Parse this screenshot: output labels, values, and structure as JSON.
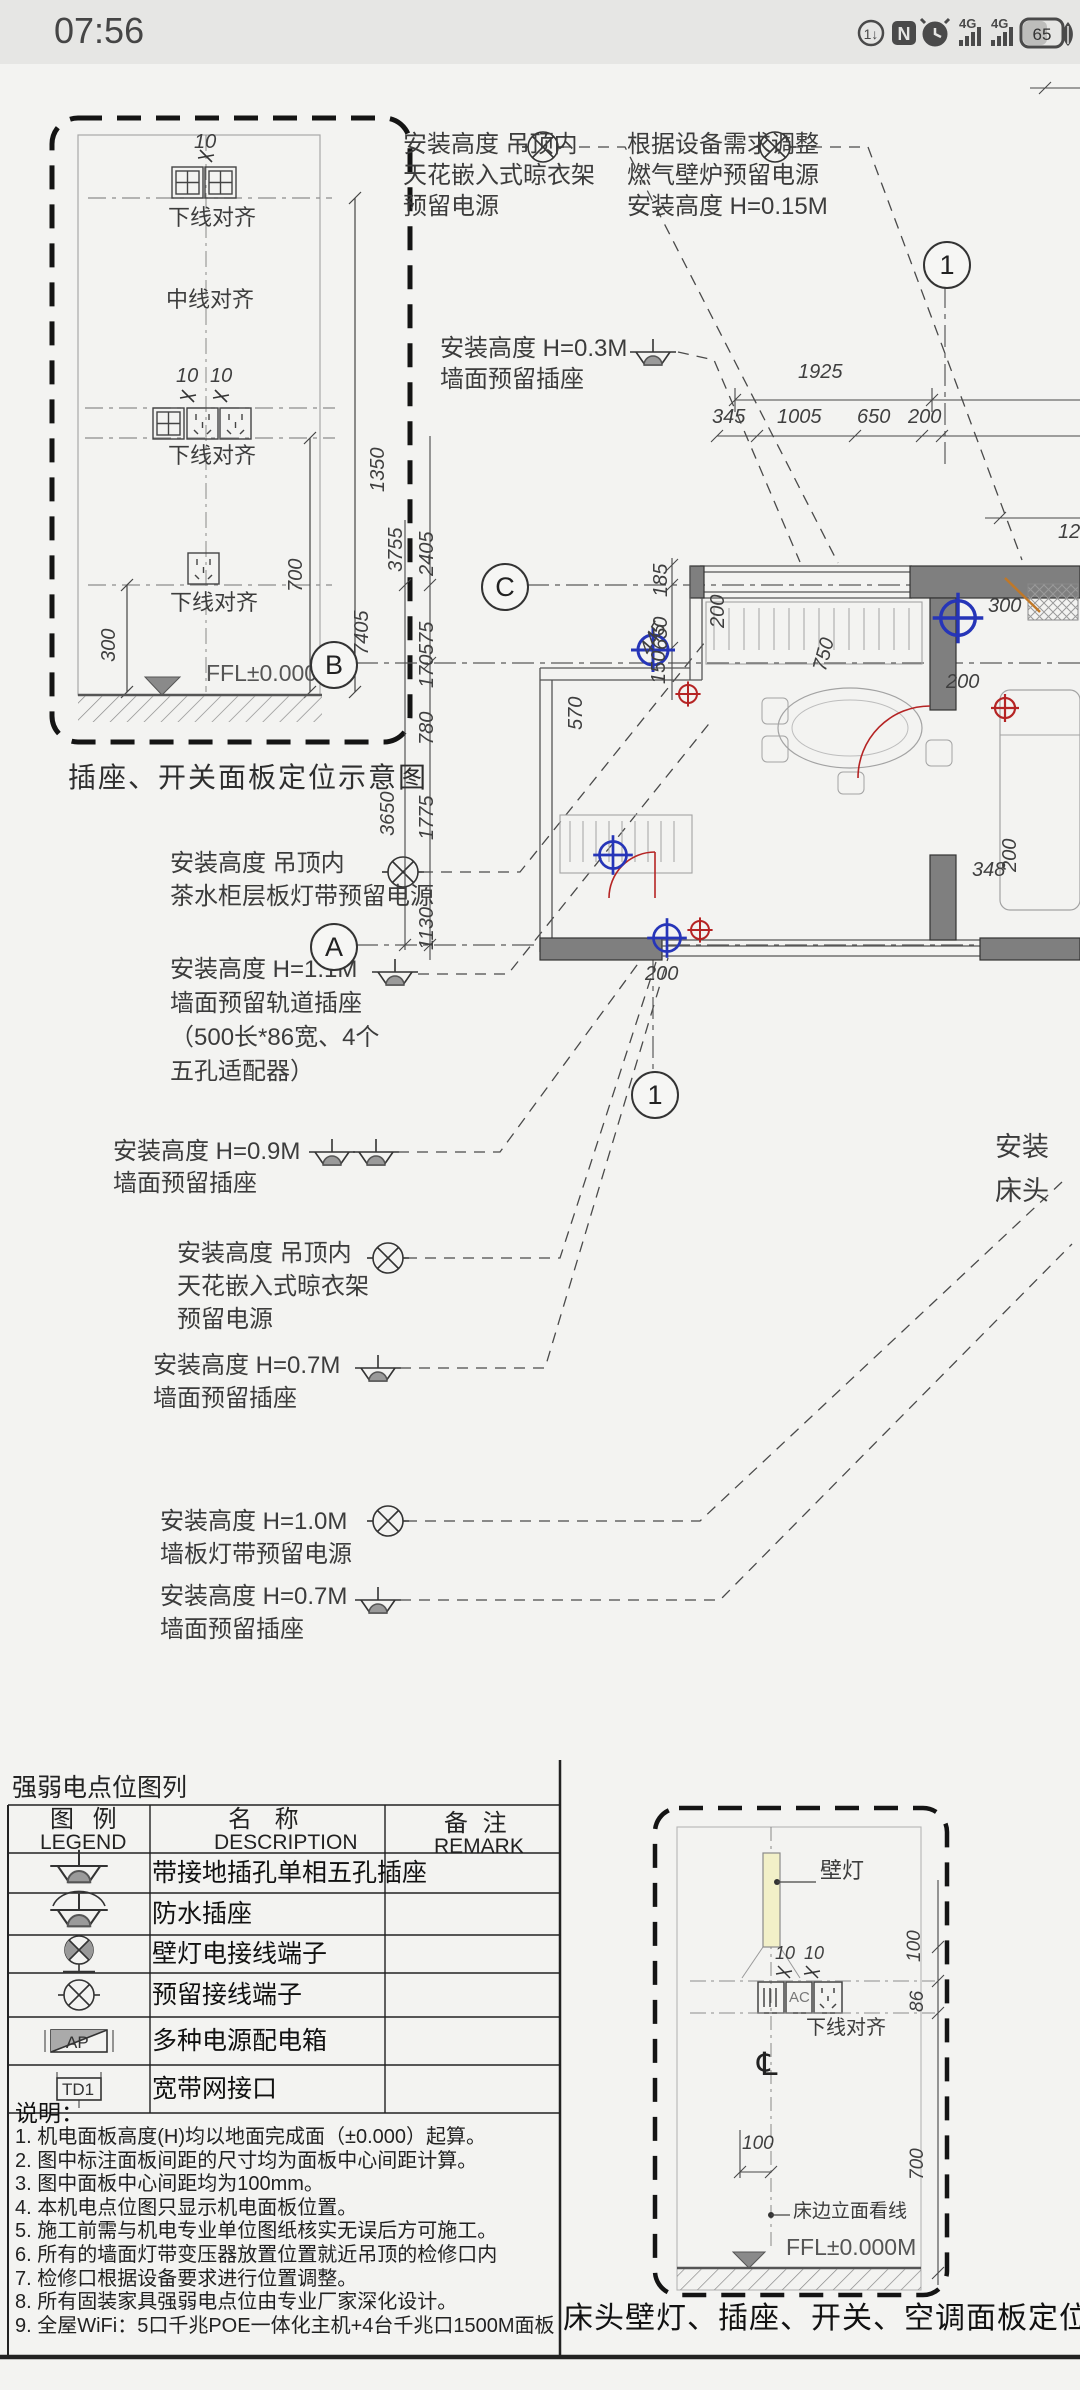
{
  "status_bar": {
    "time": "07:56",
    "battery_level": "65",
    "network_label_1": "4G",
    "network_label_2": "4G",
    "icons": [
      "data-saver-icon",
      "nfc-icon",
      "alarm-icon",
      "signal-4g-icon",
      "signal-4g-icon",
      "battery-icon",
      "eco-leaf-icon"
    ]
  },
  "detail_panel": {
    "caption": "插座、开关面板定位示意图",
    "align_label_1": "下线对齐",
    "align_label_2": "中线对齐",
    "align_label_3": "下线对齐",
    "align_label_4": "下线对齐",
    "ffl_label": "FFL±0.000M",
    "dim_10_1": "10",
    "dim_10_2": "10",
    "dim_10_3": "10",
    "dim_1350": "1350",
    "dim_700": "700",
    "dim_300": "300"
  },
  "callouts": [
    {
      "symbol": "reserved-terminal",
      "lines": [
        "安装高度 吊顶内",
        "天花嵌入式晾衣架",
        "预留电源"
      ]
    },
    {
      "symbol": "reserved-terminal",
      "lines": [
        "根据设备需求调整",
        "燃气壁炉预留电源",
        "安装高度 H=0.15M"
      ]
    },
    {
      "symbol": "socket",
      "lines": [
        "安装高度 H=0.3M",
        "墙面预留插座"
      ]
    },
    {
      "symbol": "reserved-terminal",
      "lines": [
        "安装高度 吊顶内",
        "茶水柜层板灯带预留电源"
      ]
    },
    {
      "symbol": "socket",
      "lines": [
        "安装高度 H=1.1M",
        "墙面预留轨道插座",
        "（500长*86宽、4个",
        "五孔适配器）"
      ]
    },
    {
      "symbol": "socket-double",
      "lines": [
        "安装高度 H=0.9M",
        "墙面预留插座"
      ]
    },
    {
      "symbol": "reserved-terminal",
      "lines": [
        "安装高度 吊顶内",
        "天花嵌入式晾衣架",
        "预留电源"
      ]
    },
    {
      "symbol": "socket",
      "lines": [
        "安装高度 H=0.7M",
        "墙面预留插座"
      ]
    },
    {
      "symbol": "reserved-terminal",
      "lines": [
        "安装高度 H=1.0M",
        "墙板灯带预留电源"
      ]
    },
    {
      "symbol": "socket",
      "lines": [
        "安装高度 H=0.7M",
        "墙面预留插座"
      ]
    }
  ],
  "grid_bubbles": {
    "top": "1",
    "c": "C",
    "b": "B",
    "a": "A",
    "bottom": "1"
  },
  "plan_dims": {
    "d1925": "1925",
    "d345": "345",
    "d1005": "1005",
    "d650": "650",
    "d200": "200",
    "d185": "185",
    "d650v": "650",
    "d3755": "3755",
    "d2405": "2405",
    "d7405": "7405",
    "d575": "575",
    "d170": "170",
    "d780": "780",
    "d3650": "3650",
    "d1775": "1775",
    "d1130": "1130",
    "d750": "750",
    "d200a": "200",
    "d200b": "200",
    "d300": "300",
    "d445": "445",
    "d150": "150",
    "d570": "570",
    "d348": "348",
    "d200c": "200",
    "d200d": "200",
    "d12": "12"
  },
  "edge_labels": {
    "line1": "安装",
    "line2": "床头"
  },
  "legend": {
    "title": "强弱电点位图列",
    "col1_cn": "图 例",
    "col1_en": "LEGEND",
    "col2_cn": "名  称",
    "col2_en": "DESCRIPTION",
    "col3_cn": "备 注",
    "col3_en": "REMARK",
    "symbol_ap": "AP",
    "symbol_td1": "TD1",
    "rows": [
      {
        "name": "带接地插孔单相五孔插座"
      },
      {
        "name": "防水插座"
      },
      {
        "name": "壁灯电接线端子"
      },
      {
        "name": "预留接线端子"
      },
      {
        "name": "多种电源配电箱"
      },
      {
        "name": "宽带网接口"
      }
    ]
  },
  "notes": {
    "title": "说明：",
    "items": [
      "1. 机电面板高度(H)均以地面完成面（±0.000）起算。",
      "2. 图中标注面板间距的尺寸均为面板中心间距计算。",
      "3. 图中面板中心间距均为100mm。",
      "4. 本机电点位图只显示机电面板位置。",
      "5. 施工前需与机电专业单位图纸核实无误后方可施工。",
      "6. 所有的墙面灯带变压器放置位置就近吊顶的检修口内",
      "7. 检修口根据设备要求进行位置调整。",
      "8. 所有固装家具强弱电点位由专业厂家深化设计。",
      "9. 全屋WiFi：5口千兆POE一体化主机+4台千兆口1500M面板"
    ]
  },
  "bed_panel": {
    "caption": "床头壁灯、插座、开关、空调面板定位",
    "wall_lamp_label": "壁灯",
    "ac_label": "AC",
    "align_label": "下线对齐",
    "centerline": "℄",
    "bed_line_label": "床边立面看线",
    "ffl_label": "FFL±0.000M",
    "dim_10_1": "10",
    "dim_10_2": "10",
    "dim_100_r": "100",
    "dim_86": "86",
    "dim_700": "700",
    "dim_100_b": "100"
  }
}
